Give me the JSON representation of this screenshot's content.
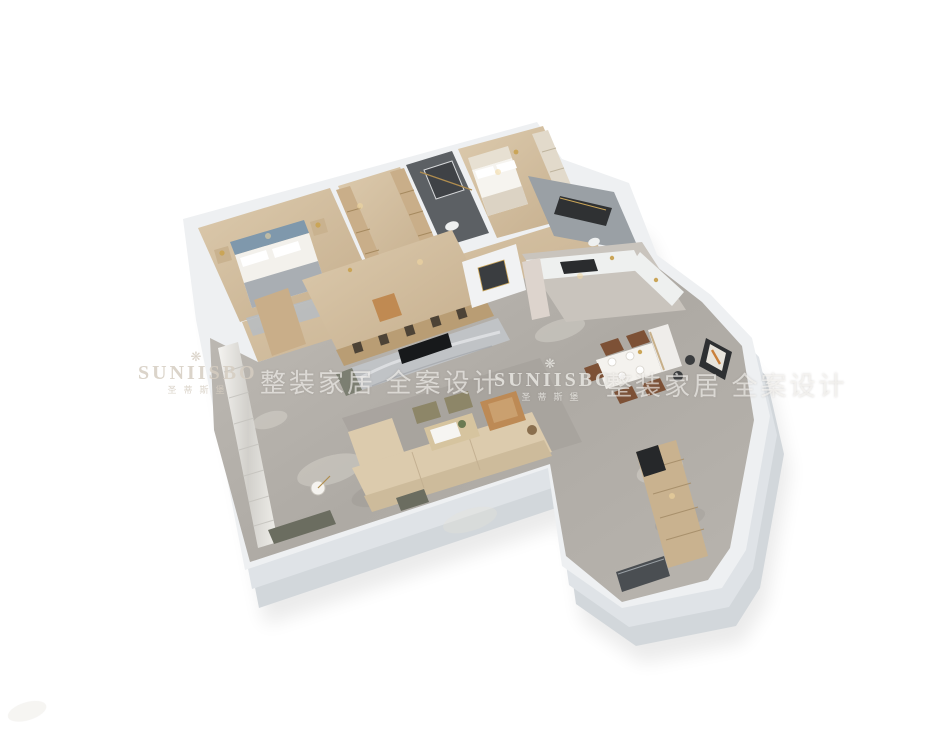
{
  "image": {
    "type": "3d-isometric-floorplan-render",
    "background": "#ffffff"
  },
  "watermark": {
    "crown_icon": "❋",
    "brand_en": "SUNIISBO",
    "brand_cn": "圣蒂斯堡",
    "tagline": "整装家居 全案设计"
  },
  "scene": {
    "rooms": [
      "master-bedroom",
      "walk-in-closet",
      "dark-bathroom",
      "second-bedroom",
      "marble-bathroom",
      "hallway",
      "study-bookshelf-room",
      "living-room",
      "dining-room",
      "open-kitchen",
      "entry-foyer-wing",
      "balcony-curtain-wall"
    ],
    "colors": {
      "wall": "#eef0f2",
      "wall_side": "#dfe3e7",
      "wall_deep": "#d2d7db",
      "wood": "#d3c0a2",
      "wood_dark": "#c7b193",
      "marble": "#b3afa9",
      "bath_dark": "#5c6064",
      "bath_gray": "#9aa0a5",
      "sofa": "#dccbad",
      "camel": "#bd8a55",
      "headboard": "#7f98ac",
      "tv_wall": "#c0c3c6",
      "cabinet_wood": "#c9b28f",
      "door_dark": "#4a4e52",
      "accent_gold": "#caa558",
      "rug": "#a7a39d",
      "kitchen_white": "#eef0ef"
    }
  }
}
